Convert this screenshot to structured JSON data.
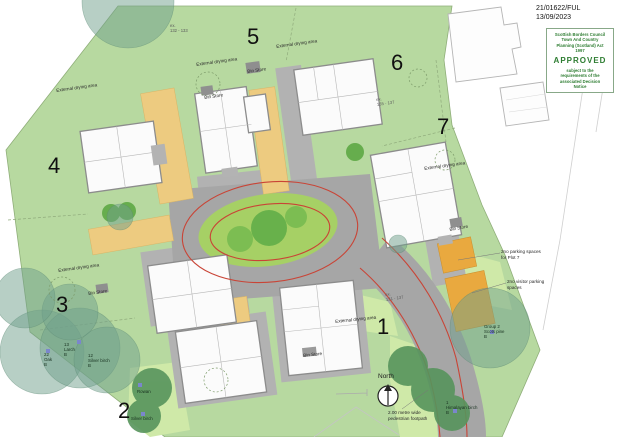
{
  "titleblock": {
    "reference": "21/01622/FUL",
    "date": "13/09/2023"
  },
  "stamp": {
    "authority": "Scottish Borders Council\nTown And Country\nPlanning (Scotland) Act\n1997",
    "status": "APPROVED",
    "note": "subject to the\nrequirements of the\nassociated Decision\nNotice",
    "text_color": "#2e7d32"
  },
  "plot_numbers": [
    "1",
    "2",
    "3",
    "4",
    "5",
    "6",
    "7"
  ],
  "labels": {
    "external_drying_area": "External drying area",
    "bin_store": "Bin Store",
    "parking_plot7": "2no parking spaces\nfor Plot 7",
    "visitor_parking": "2no visitor parking\nspaces",
    "north": "North",
    "footpath": "2.00 metre wide\npedestrian footpath",
    "level_top": "ex.\n132 - 133",
    "level_road": "ex.\n131 - 137",
    "level_plot6": "ex.\n135 - 137"
  },
  "trees": {
    "oak": "22\nOak\nB",
    "larch": "13\nLarch\nB",
    "silver_birch_a": "12\nSilver birch\nB",
    "rowan": "Rowan",
    "silver_birch_b": "Silver birch",
    "himalayan_birch": "1\nHimalayan birch\nB",
    "scots_pine": "Group 2\nScots pine\nB"
  },
  "colors": {
    "site_green": "#b7d9a0",
    "garden_green": "#cfe9a8",
    "island_green": "#a6d065",
    "tree_dark_green": "#57945c",
    "tree_teal": "#6fa08c",
    "road_gray": "#a6a6a6",
    "apron_gray": "#b2b2b2",
    "parking_yellow": "#edcb80",
    "parking_orange": "#e9a93f",
    "tracking_red": "#c94436",
    "approved_green": "#2e7d32",
    "marker_blue": "#7b86cc"
  }
}
